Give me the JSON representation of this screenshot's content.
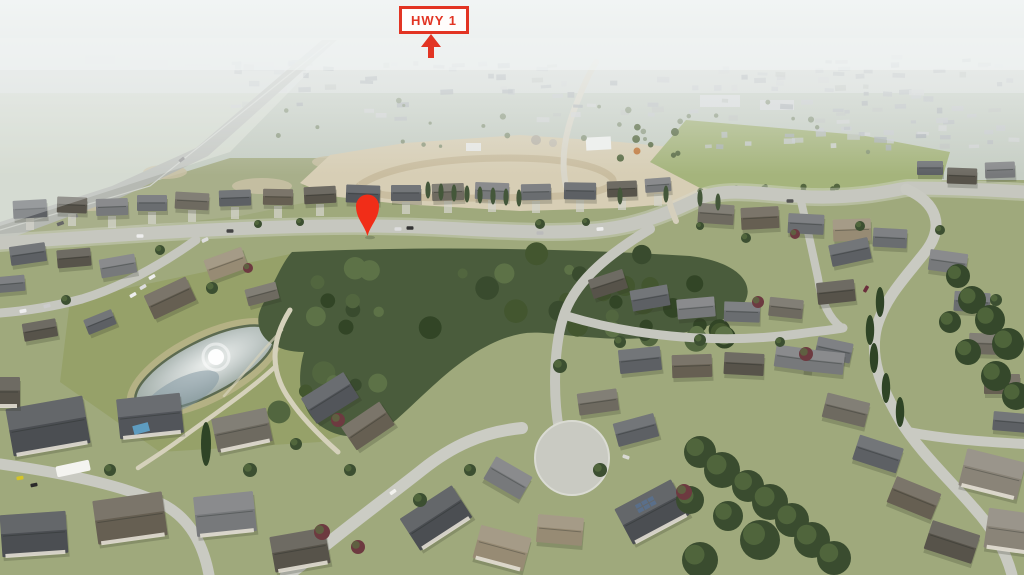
{
  "annotations": {
    "highway_label": {
      "text": "HWY 1"
    },
    "location_pin": {
      "shape": "map-pin"
    }
  },
  "colors": {
    "annotation_red": "#e23423",
    "pin_red": "#f12d18"
  }
}
